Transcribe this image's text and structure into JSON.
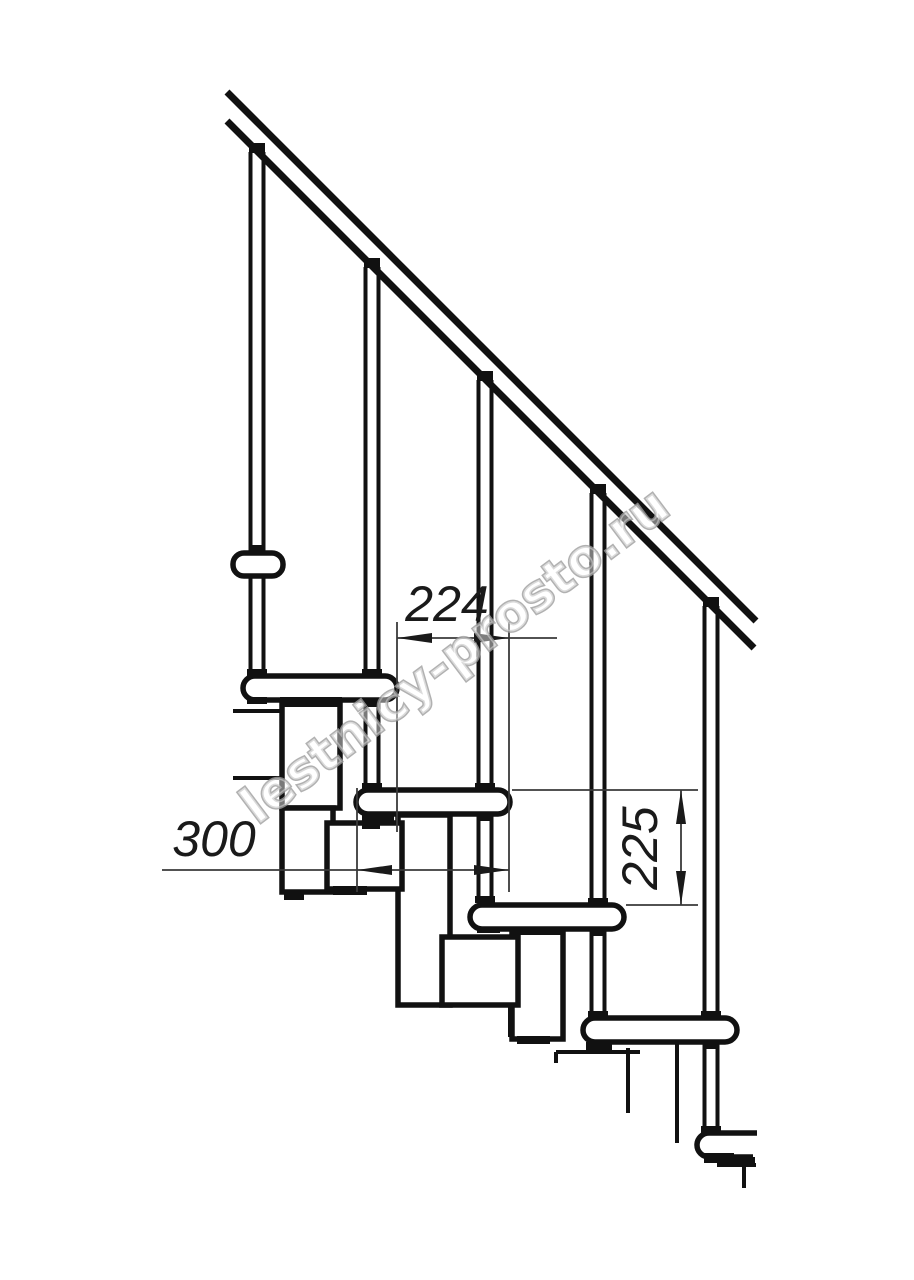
{
  "drawing": {
    "subject": "modular-staircase-side-elevation",
    "watermark": "lestnicy-prosto.ru",
    "dimensions": {
      "step_run": "224",
      "tread_depth": "300",
      "step_rise": "225"
    },
    "colors": {
      "line": "#111111",
      "dim_line": "#3a3a3a",
      "background": "#ffffff",
      "watermark_stroke": "#9e9e9e"
    }
  }
}
